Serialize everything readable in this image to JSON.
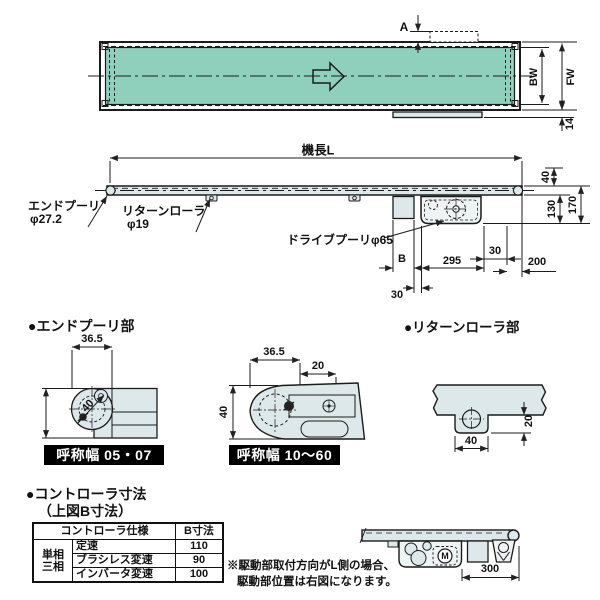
{
  "colors": {
    "belt_green": "#8fd0bc",
    "panel_fill": "#dde8ea",
    "ink": "#1b1b1b",
    "badge_bg": "#000000",
    "badge_fg": "#ffffff"
  },
  "top_view": {
    "dim_a": "A",
    "dim_bw": "BW",
    "dim_fw": "FW",
    "dim_14": "14"
  },
  "side_view": {
    "length": "機長L",
    "dim_40": "40",
    "dim_130": "130",
    "dim_170": "170",
    "end_pulley": "エンドプーリ",
    "end_pulley_dia": "φ27.2",
    "return_roller": "リターンローラ",
    "return_roller_dia": "φ19",
    "drive_pulley": "ドライブプーリφ65",
    "dim_b": "B",
    "dim_295": "295",
    "dim_30_right": "30",
    "dim_200": "200",
    "dim_30_left": "30"
  },
  "end_pulley_section": {
    "title": "●エンドプーリ部",
    "fig_small": {
      "dim_365": "36.5",
      "dim_40": "40",
      "badge": "呼称幅 05・07"
    },
    "fig_large": {
      "dim_365": "36.5",
      "dim_20": "20",
      "dim_40": "40",
      "badge": "呼称幅 10～60"
    }
  },
  "return_roller_section": {
    "title": "●リターンローラ部",
    "dim_40": "40",
    "dim_20": "20"
  },
  "controller_section": {
    "title": "●コントローラ寸法",
    "subtitle": "（上図B寸法）",
    "table": {
      "col_spec": "コントローラ仕様",
      "col_b": "B寸法",
      "phase_top": "単相",
      "phase_bottom": "三相",
      "rows": [
        {
          "name": "定速",
          "b": "110"
        },
        {
          "name": "ブラシレス変速",
          "b": "90"
        },
        {
          "name": "インバータ変速",
          "b": "100"
        }
      ]
    },
    "note_line1": "※駆動部取付方向がL側の場合、",
    "note_line2": "駆動部位置は右図になります。",
    "fig": {
      "dim_300": "300",
      "motor": "M"
    }
  }
}
